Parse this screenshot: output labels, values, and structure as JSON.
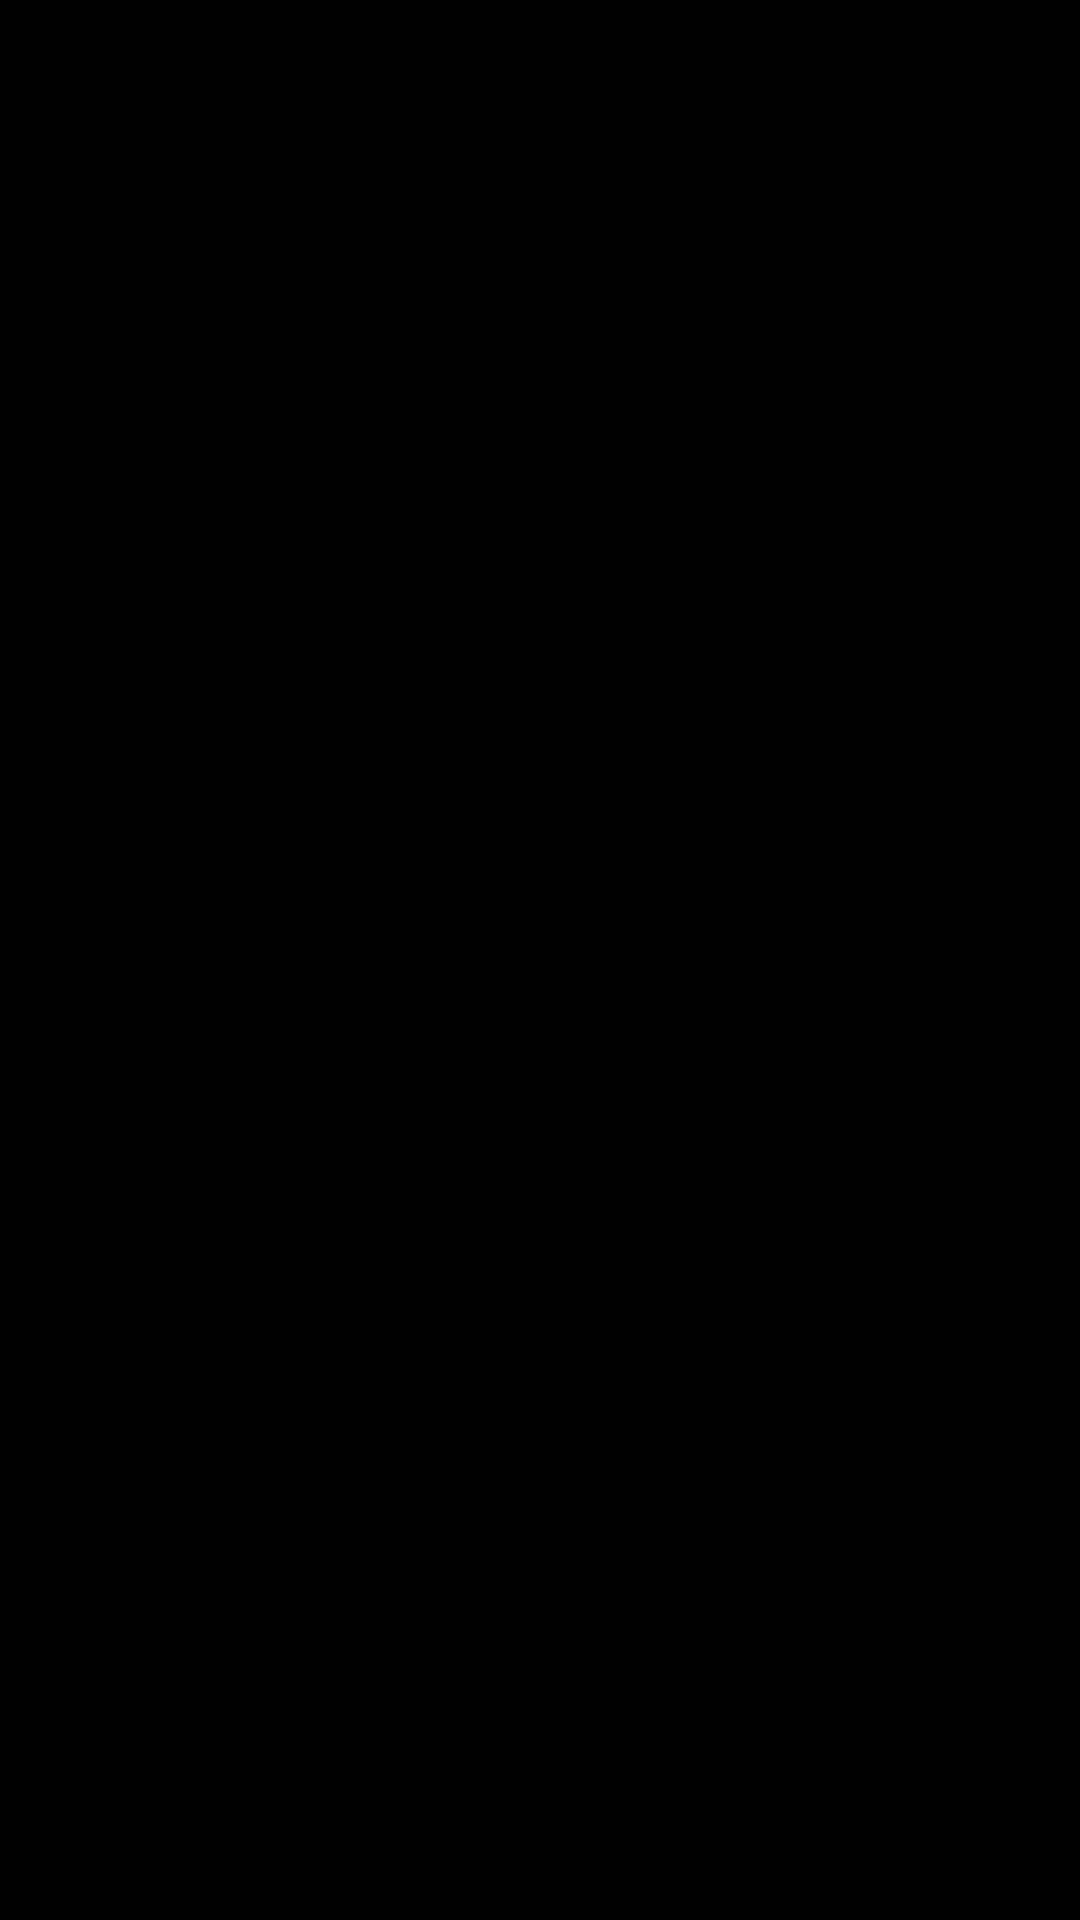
{
  "canvas": {
    "width": 1080,
    "height": 1920,
    "background": "#ffffff"
  },
  "colors": {
    "bg": "#ffffff",
    "band": "#36373a",
    "floor": "#d8d5cb",
    "floorTerrace": "#d3d0c6",
    "faceShade": "#b7b7bb",
    "faceMid": "#d6d6d9",
    "faceSoft": "#f1f1f4",
    "faceBright": "#fbfbfd",
    "faceWhite": "#f4f4f6",
    "extWhite": "#fafafb",
    "extShade": "#e9e9ec",
    "extShade2": "#dddde0",
    "glass": "#e9eeed",
    "glassDark": "#dfe6e6",
    "glassMid": "#e4ebea",
    "frame": "#ffffff",
    "pane": "#e9ebe8",
    "paneWarm": "#e7e6e0",
    "fenceBack": "#8f8f93",
    "fenceBack2": "#9a9a9e",
    "fixture": "#74747a",
    "edge": "#c9c9cd",
    "void": "#e3e3e6",
    "stepLight": "#e6e6e3",
    "stepDark": "#d9d8d5",
    "railShadow": "#d8d8da",
    "doorFace": "#fdfdfd",
    "doorEdge": "#d0d0d3"
  },
  "scene": {
    "type": "3d-floorplan-render",
    "elements": [
      "exterior-wall-band",
      "se-facade",
      "sw-facade",
      "main-floor",
      "ne-windows",
      "nw-window",
      "interior-walls",
      "door-leafs",
      "conservatory-skylight",
      "staircase",
      "annex-room",
      "annex-window",
      "entrance-door",
      "tall-window",
      "sliding-door",
      "terrace",
      "balcony-fence",
      "sink-fixture",
      "shower-fixture",
      "wc-fixture"
    ]
  }
}
